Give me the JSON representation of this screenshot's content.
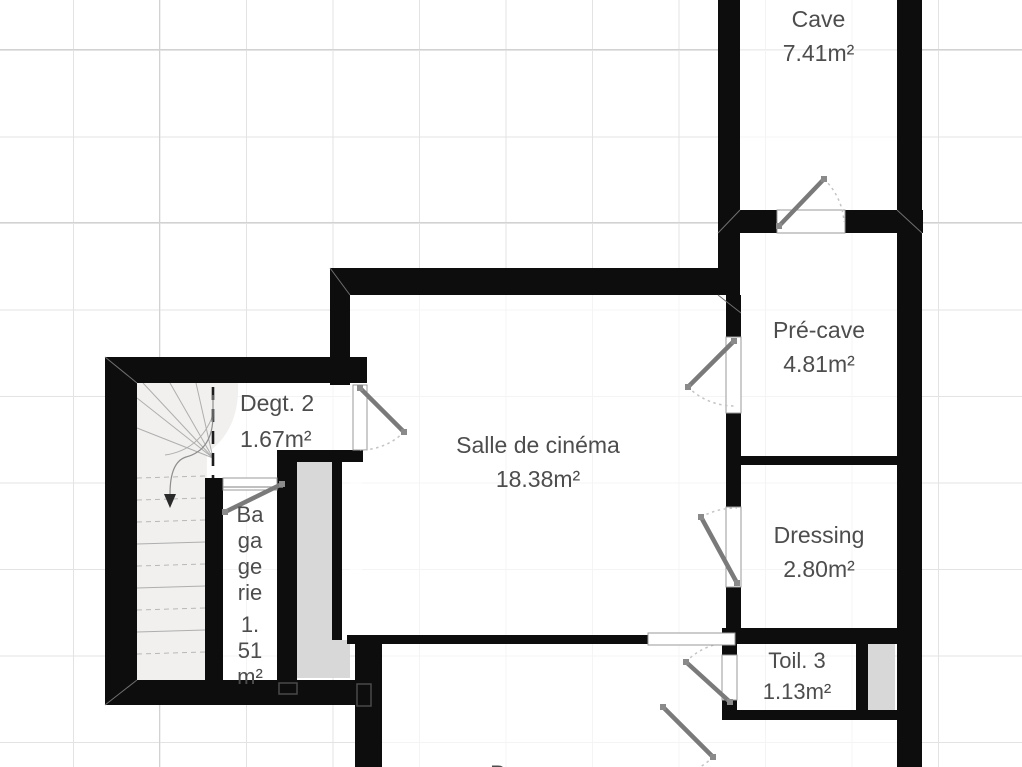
{
  "plan_title": "basement floor plan",
  "rooms": {
    "cave": {
      "name": "Cave",
      "area": "7.41m²"
    },
    "pre_cave": {
      "name": "Pré-cave",
      "area": "4.81m²"
    },
    "dressing": {
      "name": "Dressing",
      "area": "2.80m²"
    },
    "toil3": {
      "name": "Toil. 3",
      "area": "1.13m²"
    },
    "cinema": {
      "name": "Salle de cinéma",
      "area": "18.38m²"
    },
    "degt2": {
      "name": "Degt. 2",
      "area": "1.67m²"
    },
    "bagagerie": {
      "lines": [
        "Ba",
        "ga",
        "ge",
        "rie",
        "1.",
        "51",
        "m²"
      ]
    },
    "partial_bottom": {
      "name": "B"
    }
  },
  "colors": {
    "wall": "#0d0d0d",
    "duct_fill": "#d8d8d8",
    "stair_fill": "#f1f0ef",
    "door_leaf": "#7a7a7a",
    "swing_arc": "#c4c4c4",
    "grid_line": "#e3e3e3",
    "label_text": "#4d4d4d",
    "background": "#ffffff"
  }
}
